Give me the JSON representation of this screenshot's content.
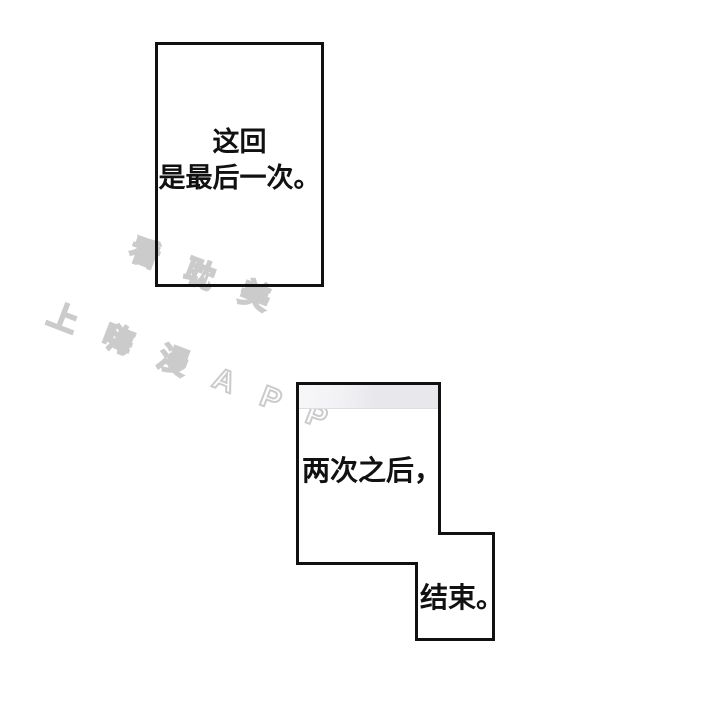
{
  "page": {
    "type": "comic-page",
    "background_color": "#ffffff",
    "panel_border_color": "#111111"
  },
  "watermark": {
    "line1": "看耽美",
    "line2": "上嗨漫APP",
    "outline_color": "#cbcbcb",
    "rotation_deg": 21
  },
  "panels": {
    "panel1": {
      "line1": "这回",
      "line2": "是最后一次。"
    },
    "panel2": {
      "caption": "两次之后，",
      "band_color": "#e8e8ec"
    },
    "panel3": {
      "caption": "结束。"
    }
  }
}
